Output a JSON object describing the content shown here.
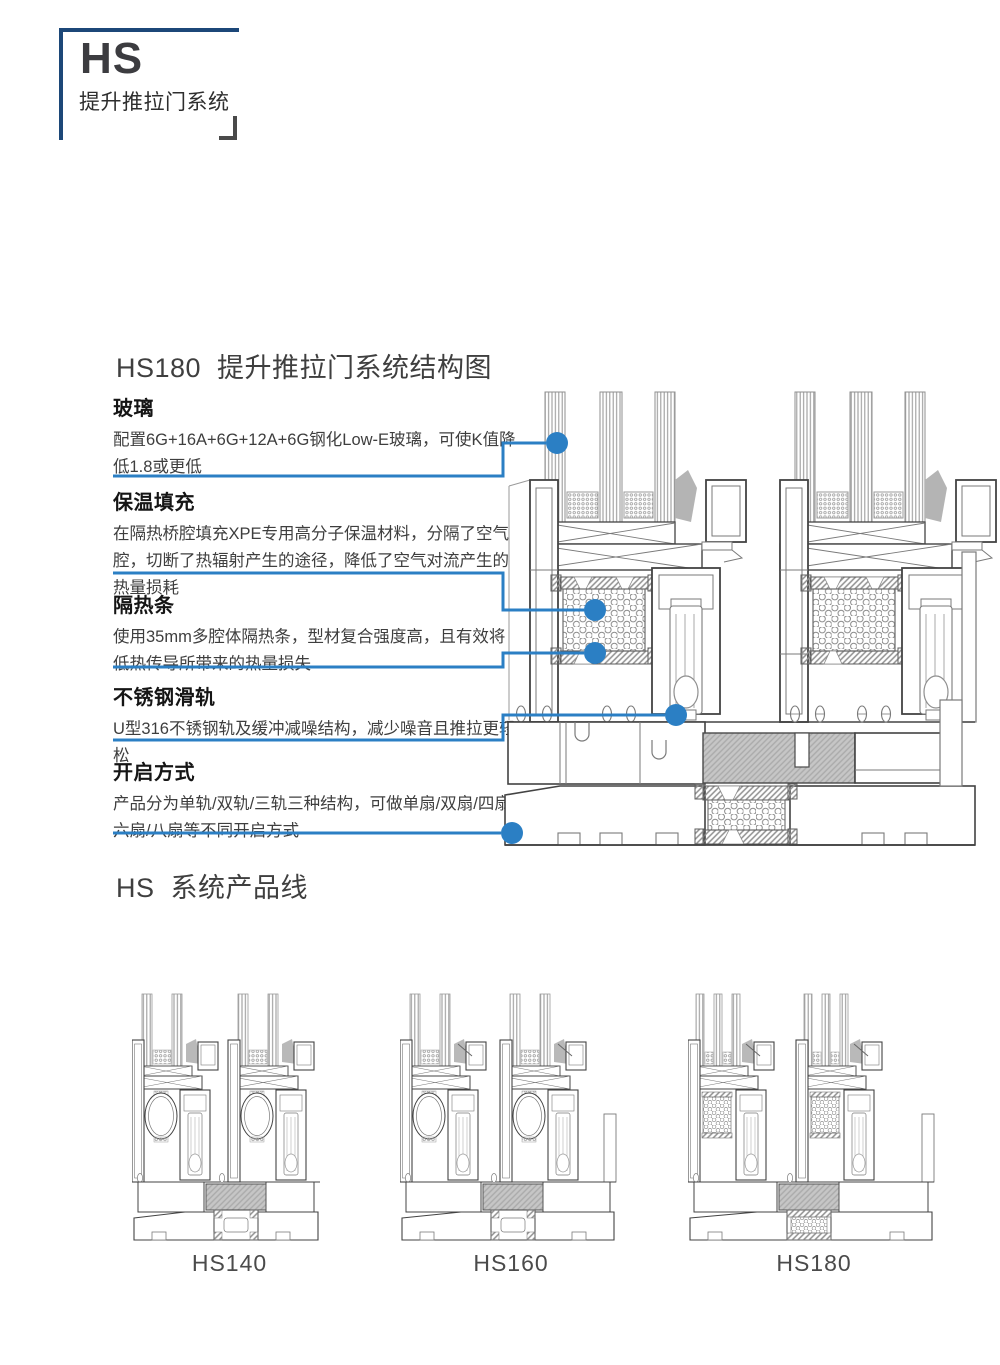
{
  "logo": {
    "title": "HS",
    "subtitle": "提升推拉门系统"
  },
  "colors": {
    "brand_navy": "#1c4778",
    "accent_blue": "#2b7fc4",
    "drawing_ink": "#434343",
    "drawing_mid": "#7a7a7a",
    "insulation_gray": "#c6c6c6"
  },
  "structure_section": {
    "title": "HS180  提升推拉门系统结构图",
    "features": [
      {
        "heading": "玻璃",
        "body": "配置6G+16A+6G+12A+6G钢化Low-E玻璃，可使K值降低1.8或更低"
      },
      {
        "heading": "保温填充",
        "body": "在隔热桥腔填充XPE专用高分子保温材料，分隔了空气腔，切断了热辐射产生的途径，降低了空气对流产生的热量损耗"
      },
      {
        "heading": "隔热条",
        "body": "使用35mm多腔体隔热条，型材复合强度高，且有效将低热传导所带来的热量损失"
      },
      {
        "heading": "不锈钢滑轨",
        "body": "U型316不锈钢轨及缓冲减噪结构，减少噪音且推拉更轻松"
      },
      {
        "heading": "开启方式",
        "body": "产品分为单轨/双轨/三轨三种结构，可做单扇/双扇/四扇/六扇/八扇等不同开启方式"
      }
    ]
  },
  "products_section": {
    "title": "HS  系统产品线",
    "products": [
      {
        "label": "HS140"
      },
      {
        "label": "HS160"
      },
      {
        "label": "HS180"
      }
    ]
  }
}
